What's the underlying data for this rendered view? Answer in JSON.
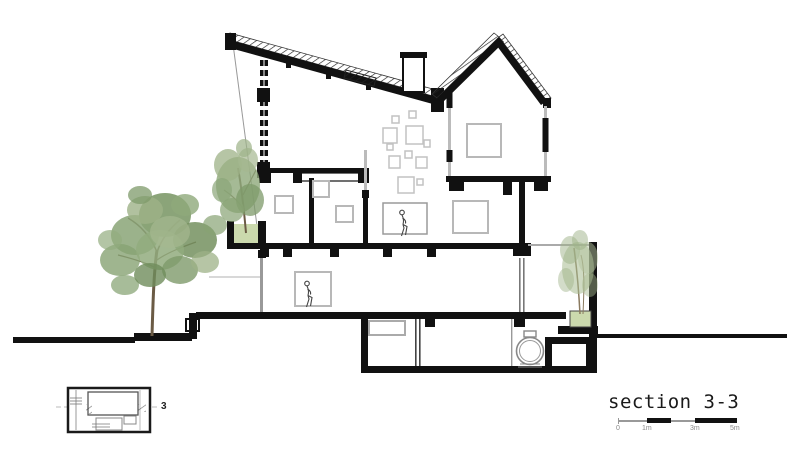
{
  "sheet": {
    "title": "section 3-3",
    "key_plan_label": "3",
    "scale_bar": {
      "labels": [
        "0",
        "1m",
        "3m",
        "5m"
      ]
    }
  },
  "colors": {
    "ink": "#111111",
    "frame_gray": "#b8b8b8",
    "foliage_dark": "#6f8c5b",
    "foliage_mid": "#87a273",
    "foliage_light": "#a5b890",
    "planter_fill": "#cbd9ad",
    "trunk_brown": "#6b5b45"
  }
}
